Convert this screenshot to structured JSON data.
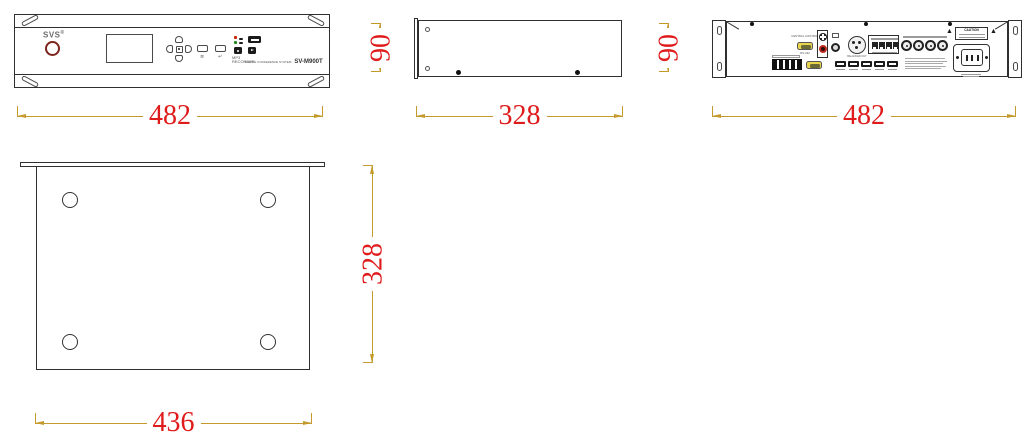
{
  "drawing_title": "rack unit dimensional drawing",
  "colors": {
    "outline": "#2f2f2f",
    "dimension_line": "#c49a2c",
    "dimension_text": "#e01b1b",
    "brand_ring_red": "#7b241c",
    "rca_red": "#c2281e",
    "led_red": "#cc2200",
    "led_green": "#1e8a1e"
  },
  "front_view": {
    "brand": "SVS",
    "brand_reg": "®",
    "mp3_label": "MP3 RECORDER",
    "system_label": "DIGITAL CONFERENCE SYSTEM",
    "model": "SV-M900T",
    "menu_icon_glyph": "≡",
    "back_icon_glyph": "↵"
  },
  "rear_view": {
    "caution": "CAUTION",
    "warning_glyph": "▲",
    "central_control": "CENTRAL CONTROL",
    "rs232": "RS-232",
    "balanced_out": "BALANCED OUT"
  },
  "dimensions": {
    "front_width": "482",
    "side_depth": "328",
    "rear_width": "482",
    "side_height": "90",
    "rear_height": "90",
    "bottom_width": "436",
    "bottom_depth": "328"
  }
}
